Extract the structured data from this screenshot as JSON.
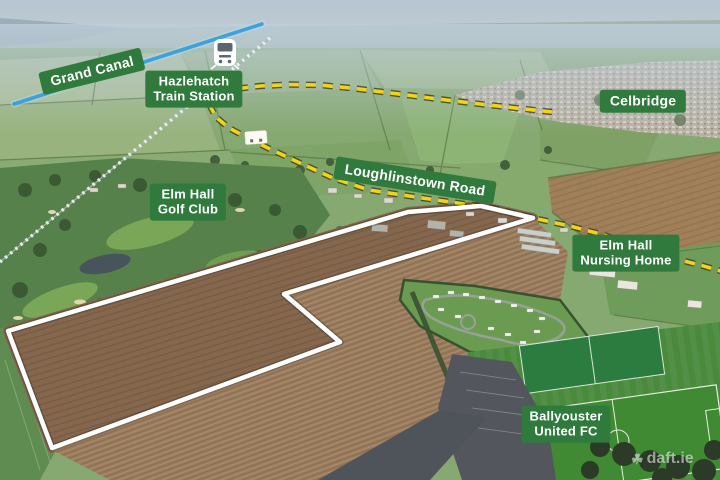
{
  "scene": {
    "type": "aerial-photograph",
    "watermark": {
      "text": "daft.ie",
      "icon": "shamrock-icon"
    }
  },
  "labels": {
    "grand_canal": {
      "text": "Grand Canal"
    },
    "hazlehatch_station": {
      "line1": "Hazlehatch",
      "line2": "Train Station",
      "icon": "train-icon"
    },
    "celbridge": {
      "text": "Celbridge"
    },
    "elm_hall_golf_club": {
      "line1": "Elm Hall",
      "line2": "Golf Club"
    },
    "loughlinstown_road": {
      "text": "Loughlinstown Road"
    },
    "elm_hall_nursing_home": {
      "line1": "Elm Hall",
      "line2": "Nursing Home"
    },
    "ballyouster_united_fc": {
      "line1": "Ballyouster",
      "line2": "United FC"
    }
  },
  "colors": {
    "label_green": "#2f7a3c",
    "road_yellow": "#f2d414",
    "canal_blue": "#3ea2da",
    "outline_white": "#ffffff"
  }
}
